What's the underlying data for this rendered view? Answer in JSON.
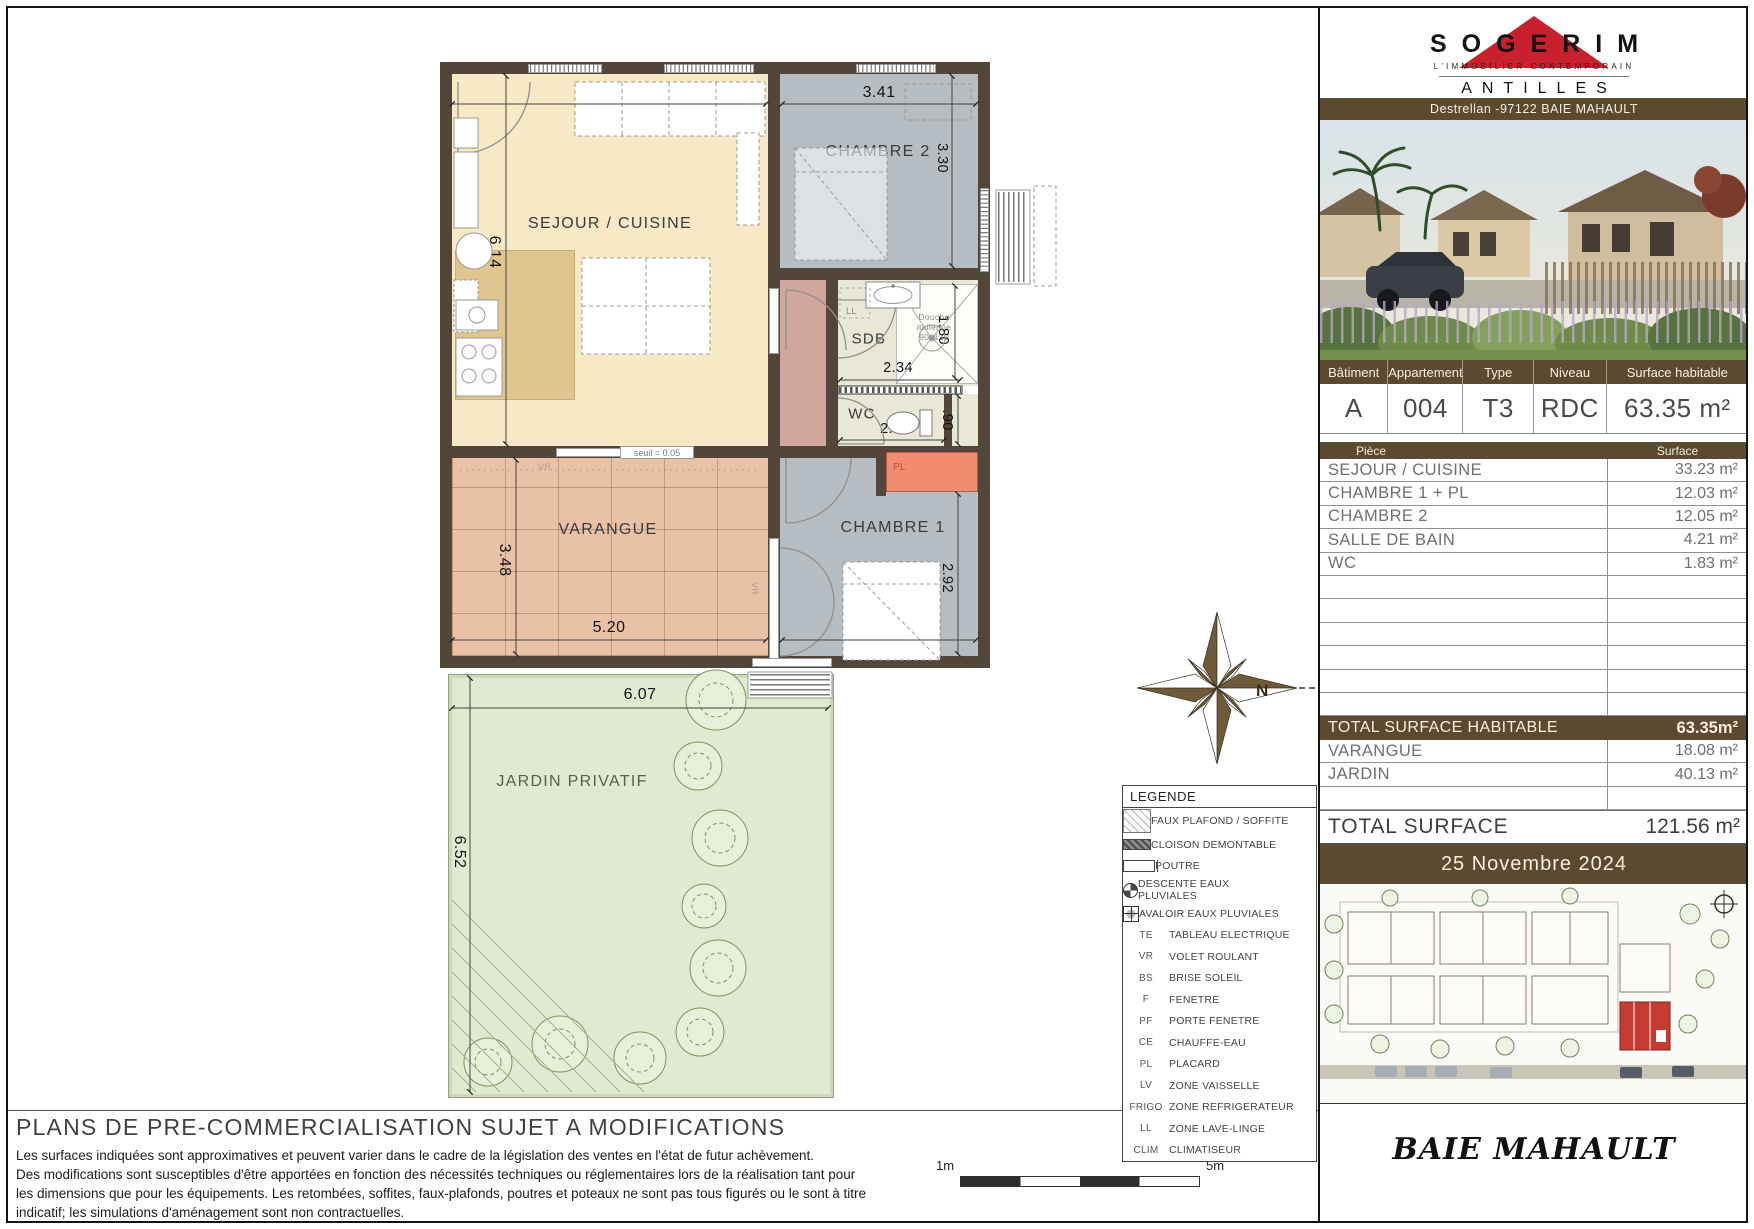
{
  "sidebar": {
    "logo": {
      "brand": "SOGERIM",
      "tagline": "L'IMMOBILIER CONTEMPORAIN",
      "region": "ANTILLES"
    },
    "address": "Destrellan -97122 BAIE MAHAULT",
    "summary": {
      "headers": [
        "Bâtiment",
        "Appartement",
        "Type",
        "Niveau",
        "Surface habitable"
      ],
      "values": [
        "A",
        "004",
        "T3",
        "RDC",
        "63.35 m²"
      ]
    },
    "table": {
      "piece_header": "Pièce",
      "surface_header": "Surface",
      "rows": [
        {
          "label": "SEJOUR / CUISINE",
          "value": "33.23 m²"
        },
        {
          "label": "CHAMBRE 1 + PL",
          "value": "12.03 m²"
        },
        {
          "label": "CHAMBRE 2",
          "value": "12.05 m²"
        },
        {
          "label": "SALLE DE BAIN",
          "value": "4.21 m²"
        },
        {
          "label": "WC",
          "value": "1.83 m²"
        },
        {
          "label": "",
          "value": ""
        },
        {
          "label": "",
          "value": ""
        },
        {
          "label": "",
          "value": ""
        },
        {
          "label": "",
          "value": ""
        },
        {
          "label": "",
          "value": ""
        },
        {
          "label": "",
          "value": ""
        }
      ],
      "total_habitable": {
        "label": "TOTAL SURFACE HABITABLE",
        "value": "63.35m²"
      },
      "annex_rows": [
        {
          "label": "VARANGUE",
          "value": "18.08 m²"
        },
        {
          "label": "JARDIN",
          "value": "40.13 m²"
        },
        {
          "label": "",
          "value": ""
        }
      ],
      "total": {
        "label": "TOTAL SURFACE",
        "value": "121.56 m²"
      }
    },
    "date": "25 Novembre 2024",
    "city": "BAIE MAHAULT"
  },
  "plan": {
    "labels": {
      "sejour": "SEJOUR / CUISINE",
      "chambre2": "CHAMBRE 2",
      "chambre1": "CHAMBRE 1",
      "sdb": "SDB",
      "wc": "WC",
      "varangue": "VARANGUE",
      "jardin": "JARDIN PRIVATIF",
      "placard": "PL",
      "te": "TE",
      "pl_left": "PL",
      "ecs": "ECS",
      "frigo": "FRIGO",
      "ll": "LL",
      "vr": "VR",
      "vr2": "VR",
      "seuil": "seuil = 0.05",
      "douche": "Douche italienne 90x120"
    },
    "dims": {
      "sejour_w": "5.19",
      "chambre2_w": "3.41",
      "chambre2_h": "3.30",
      "sejour_h": "6.14",
      "sdb_w": "2.34",
      "sdb_h": "1.80",
      "wc_w": "2.04",
      "wc_h": ".90",
      "chambre1_h": "2.92",
      "varangue_w": "5.20",
      "chambre1_w": "3.41",
      "varangue_h": "3.48",
      "jardin_w": "6.07",
      "jardin_h": "6.52"
    },
    "compass_n": "N"
  },
  "legend": {
    "title": "LEGENDE",
    "items": [
      {
        "icon": "hatch-light",
        "abbr": "",
        "label": "FAUX PLAFOND / SOFFITE"
      },
      {
        "icon": "hatch-dark",
        "abbr": "",
        "label": "CLOISON DEMONTABLE"
      },
      {
        "icon": "beam",
        "abbr": "",
        "label": "POUTRE"
      },
      {
        "icon": "drain",
        "abbr": "",
        "label": "DESCENTE EAUX PLUVIALES"
      },
      {
        "icon": "avaloir",
        "abbr": "",
        "label": "AVALOIR EAUX PLUVIALES"
      },
      {
        "abbr": "TE",
        "label": "TABLEAU ELECTRIQUE"
      },
      {
        "abbr": "VR",
        "label": "VOLET ROULANT"
      },
      {
        "abbr": "BS",
        "label": "BRISE SOLEIL"
      },
      {
        "abbr": "F",
        "label": "FENETRE"
      },
      {
        "abbr": "PF",
        "label": "PORTE FENETRE"
      },
      {
        "abbr": "CE",
        "label": "CHAUFFE-EAU"
      },
      {
        "abbr": "PL",
        "label": "PLACARD"
      },
      {
        "abbr": "LV",
        "label": "ZONE VAISSELLE"
      },
      {
        "abbr": "FRIGO",
        "label": "ZONE REFRIGERATEUR"
      },
      {
        "abbr": "LL",
        "label": "ZONE LAVE-LINGE"
      },
      {
        "abbr": "CLIM",
        "label": "CLIMATISEUR"
      }
    ]
  },
  "scalebar": {
    "left": "1m",
    "right": "5m"
  },
  "disclaimer": {
    "title": "PLANS DE PRE-COMMERCIALISATION SUJET A MODIFICATIONS",
    "lines": [
      "Les surfaces indiquées sont approximatives et peuvent varier dans le cadre de la législation des ventes en l'état de futur achèvement.",
      "Des modifications sont susceptibles d'être apportées en fonction des nécessités techniques ou réglementaires lors de la réalisation tant pour",
      "les dimensions que pour les équipements. Les retombées, soffites, faux-plafonds, poutres et poteaux ne sont pas tous figurés ou le sont à titre",
      "indicatif; les simulations d'aménagement sont non contractuelles."
    ]
  },
  "colors": {
    "brand_red": "#c9202e",
    "brown": "#5b4930",
    "wall": "#52453a",
    "placard_salmon": "#f08d71",
    "site_unit_red": "#c63b30"
  }
}
